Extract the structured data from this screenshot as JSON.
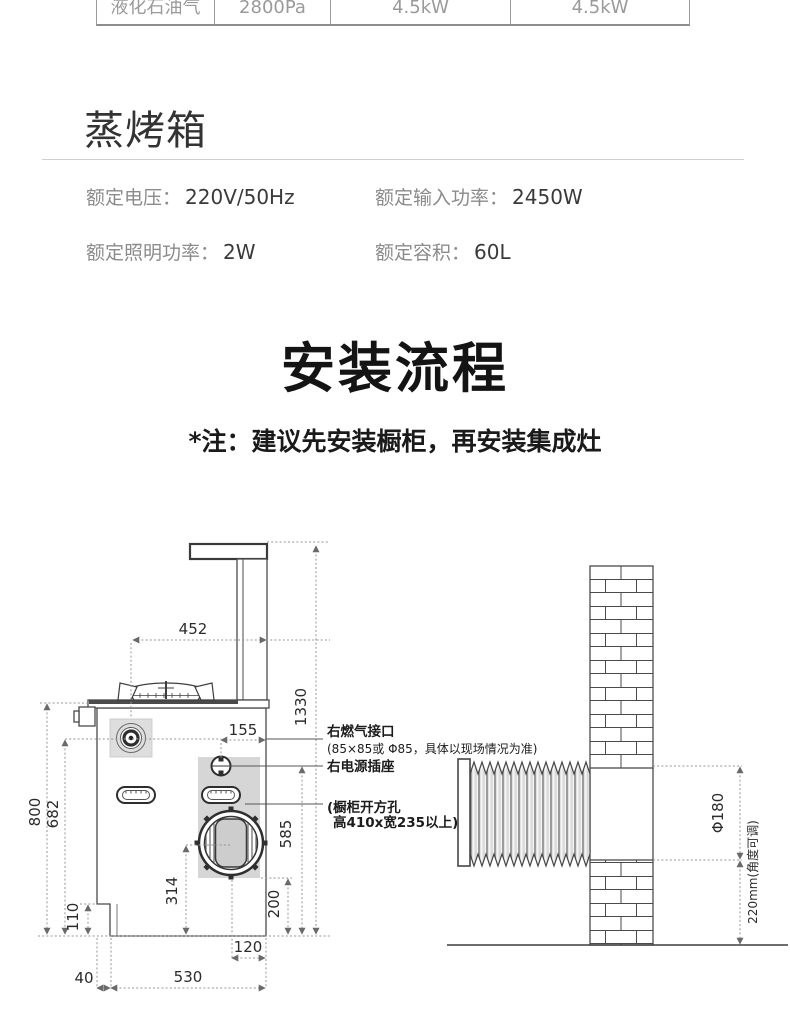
{
  "gas_table": {
    "row": [
      "液化石油气",
      "2800Pa",
      "4.5kW",
      "4.5kW"
    ]
  },
  "steam_oven": {
    "title": "蒸烤箱",
    "specs": [
      {
        "label": "额定电压：",
        "value": "220V/50Hz"
      },
      {
        "label": "额定输入功率：",
        "value": "2450W"
      },
      {
        "label": "额定照明功率：",
        "value": "2W"
      },
      {
        "label": "额定容积：",
        "value": "60L"
      }
    ]
  },
  "installation": {
    "title": "安装流程",
    "note": "*注：建议先安装橱柜，再安装集成灶"
  },
  "diagram": {
    "dimensions": {
      "burner_offset": "452",
      "total_height": "1330",
      "gas_offset": "155",
      "body_height": "800",
      "gas_height": "682",
      "toe_height": "110",
      "outlet_height": "314",
      "opening_bottom": "200",
      "socket_height": "585",
      "outlet_offset": "120",
      "toe_inset": "40",
      "base_width": "530",
      "duct_diameter": "Φ180",
      "duct_height": "220mm(角度可调)"
    },
    "callouts": {
      "gas_port": "右燃气接口",
      "gas_port_note": "(85×85或 Φ85，具体以现场情况为准)",
      "power_socket": "右电源插座",
      "cabinet_opening_line1": "(橱柜开方孔",
      "cabinet_opening_line2": "高410x宽235以上)"
    },
    "colors": {
      "shade": "#d6d6d6",
      "line": "#4a4a4a",
      "dim": "#949494"
    }
  }
}
